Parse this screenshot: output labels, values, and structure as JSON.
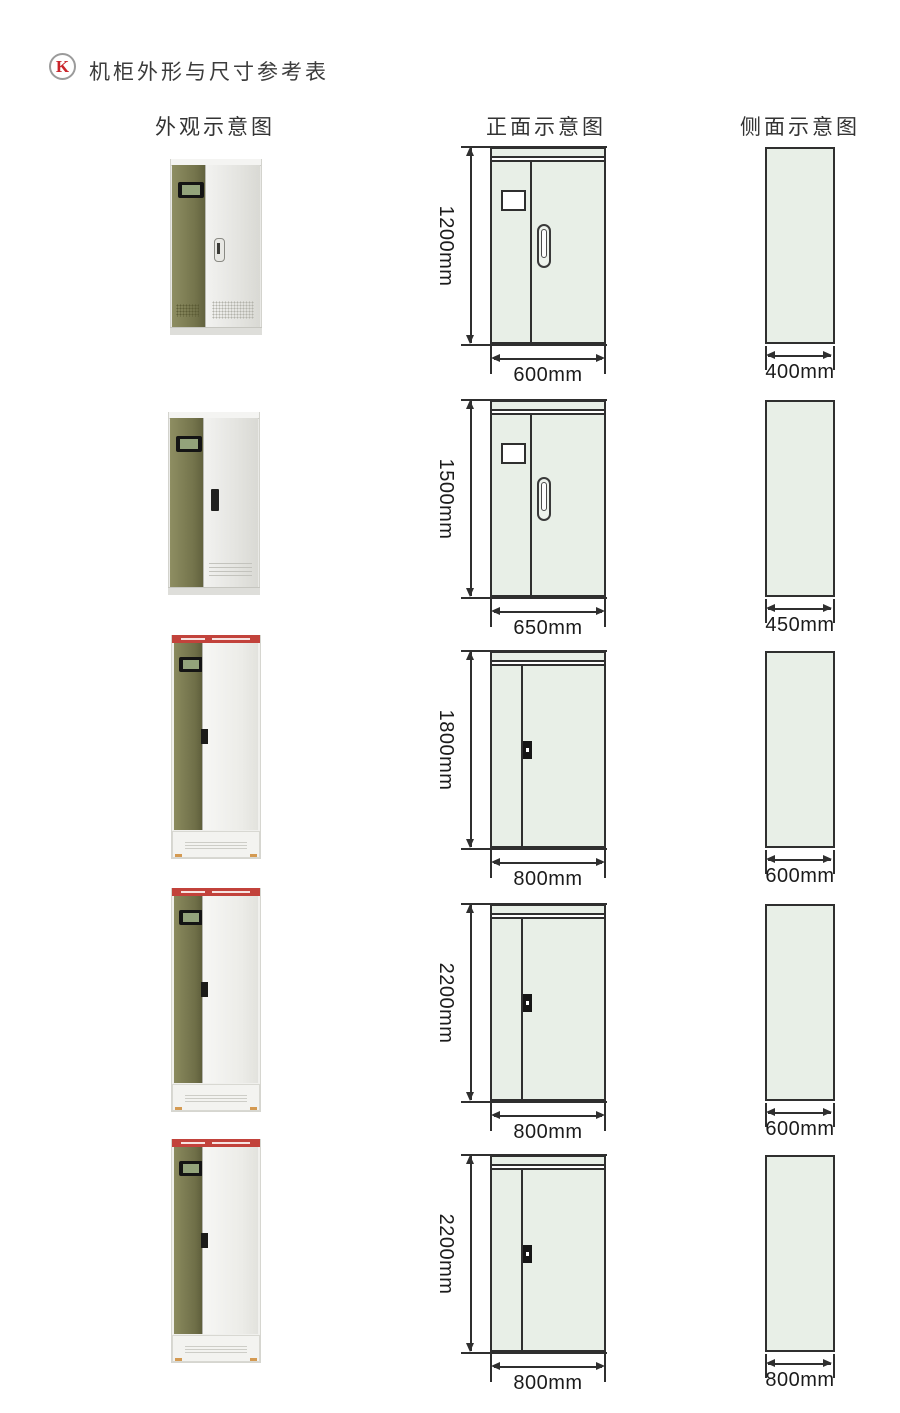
{
  "header": {
    "badge": "K",
    "title": "机柜外形与尺寸参考表"
  },
  "columns": {
    "appearance": "外观示意图",
    "front": "正面示意图",
    "side": "侧面示意图"
  },
  "rows": [
    {
      "height": "1200mm",
      "width": "600mm",
      "depth": "400mm",
      "front_style": "double-door-with-window-and-oval-handle",
      "photo_style": "olive-strip-cabinet"
    },
    {
      "height": "1500mm",
      "width": "650mm",
      "depth": "450mm",
      "front_style": "double-door-with-window-and-oval-handle",
      "photo_style": "olive-strip-cabinet"
    },
    {
      "height": "1800mm",
      "width": "800mm",
      "depth": "600mm",
      "front_style": "plain-door-with-dark-latch",
      "photo_style": "tall-olive-strip-cabinet-red-banner"
    },
    {
      "height": "2200mm",
      "width": "800mm",
      "depth": "600mm",
      "front_style": "plain-door-with-dark-latch",
      "photo_style": "tall-olive-strip-cabinet-red-banner"
    },
    {
      "height": "2200mm",
      "width": "800mm",
      "depth": "800mm",
      "front_style": "plain-door-with-dark-latch",
      "photo_style": "tall-olive-strip-cabinet-red-banner"
    }
  ],
  "colors": {
    "badge_red": "#c9252b",
    "diagram_fill": "#e8efe7",
    "dim_line": "#2f2f2f",
    "cabinet_olive": "#74744c",
    "banner_red": "#c2423b"
  }
}
